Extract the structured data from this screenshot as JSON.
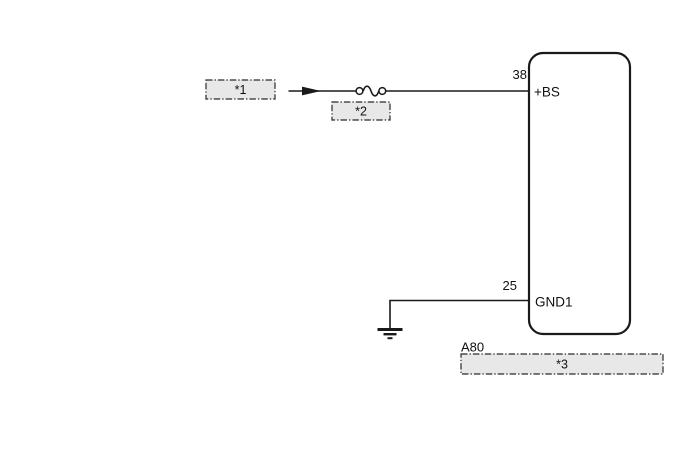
{
  "diagram": {
    "type": "wiring-diagram",
    "component": {
      "connector_code": "A80",
      "pins": [
        {
          "number": "38",
          "name": "+BS"
        },
        {
          "number": "25",
          "name": "GND1"
        }
      ]
    },
    "callouts": [
      {
        "label": "*1"
      },
      {
        "label": "*2"
      },
      {
        "label": "*3"
      }
    ],
    "symbols": [
      "power-flow-arrow",
      "fuse-symbol",
      "ground-symbol"
    ],
    "colors": {
      "line": "#1a1a1a",
      "text": "#111111",
      "callout_fill": "#e8e8e8",
      "background": "#ffffff"
    }
  }
}
